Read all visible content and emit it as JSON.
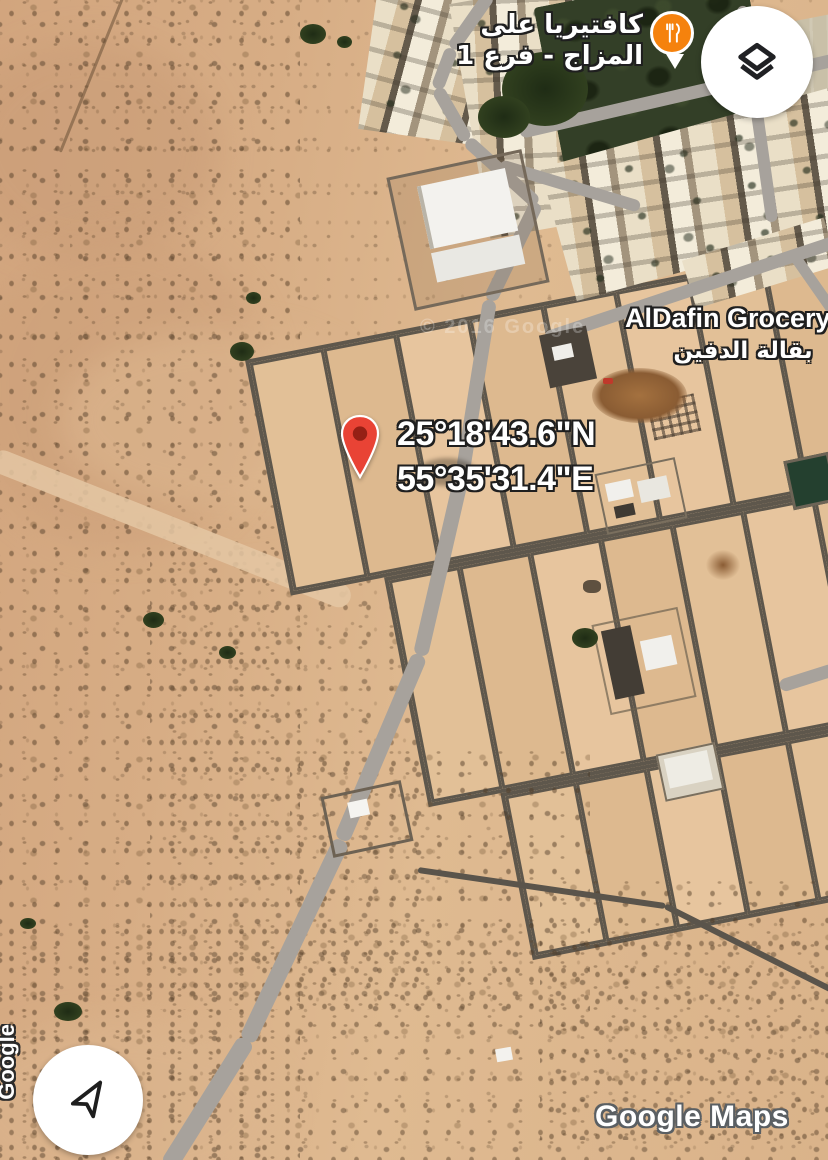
{
  "map": {
    "view": "satellite",
    "attribution": "Google Maps",
    "side_attribution": "Google",
    "faint_watermark": "© 2016 Google"
  },
  "dropped_pin": {
    "coordinates": {
      "lat": "25°18'43.6\"N",
      "lng": "55°35'31.4\"E"
    },
    "color": "#EA4335",
    "inner_color": "#952015"
  },
  "places": [
    {
      "id": "cafeteria",
      "label_ar_line1": "كافتيريا على",
      "label_ar_line2": "المزاج - فرع 1",
      "icon": "restaurant-pin-icon",
      "pin_color": "#F5820D"
    },
    {
      "id": "grocery",
      "name": "AlDafin Grocery",
      "name_ar": "بقالة الدفين"
    }
  ],
  "controls": {
    "layers_button": {
      "icon": "layers-icon"
    },
    "my_location_button": {
      "icon": "navigation-arrow-icon"
    }
  },
  "terrain_colors": {
    "desert": "#d7ad85",
    "plots": "#e2c097",
    "road_gray": "#a7a29c",
    "plot_road": "#5e574c",
    "field_green": "#333f27"
  }
}
